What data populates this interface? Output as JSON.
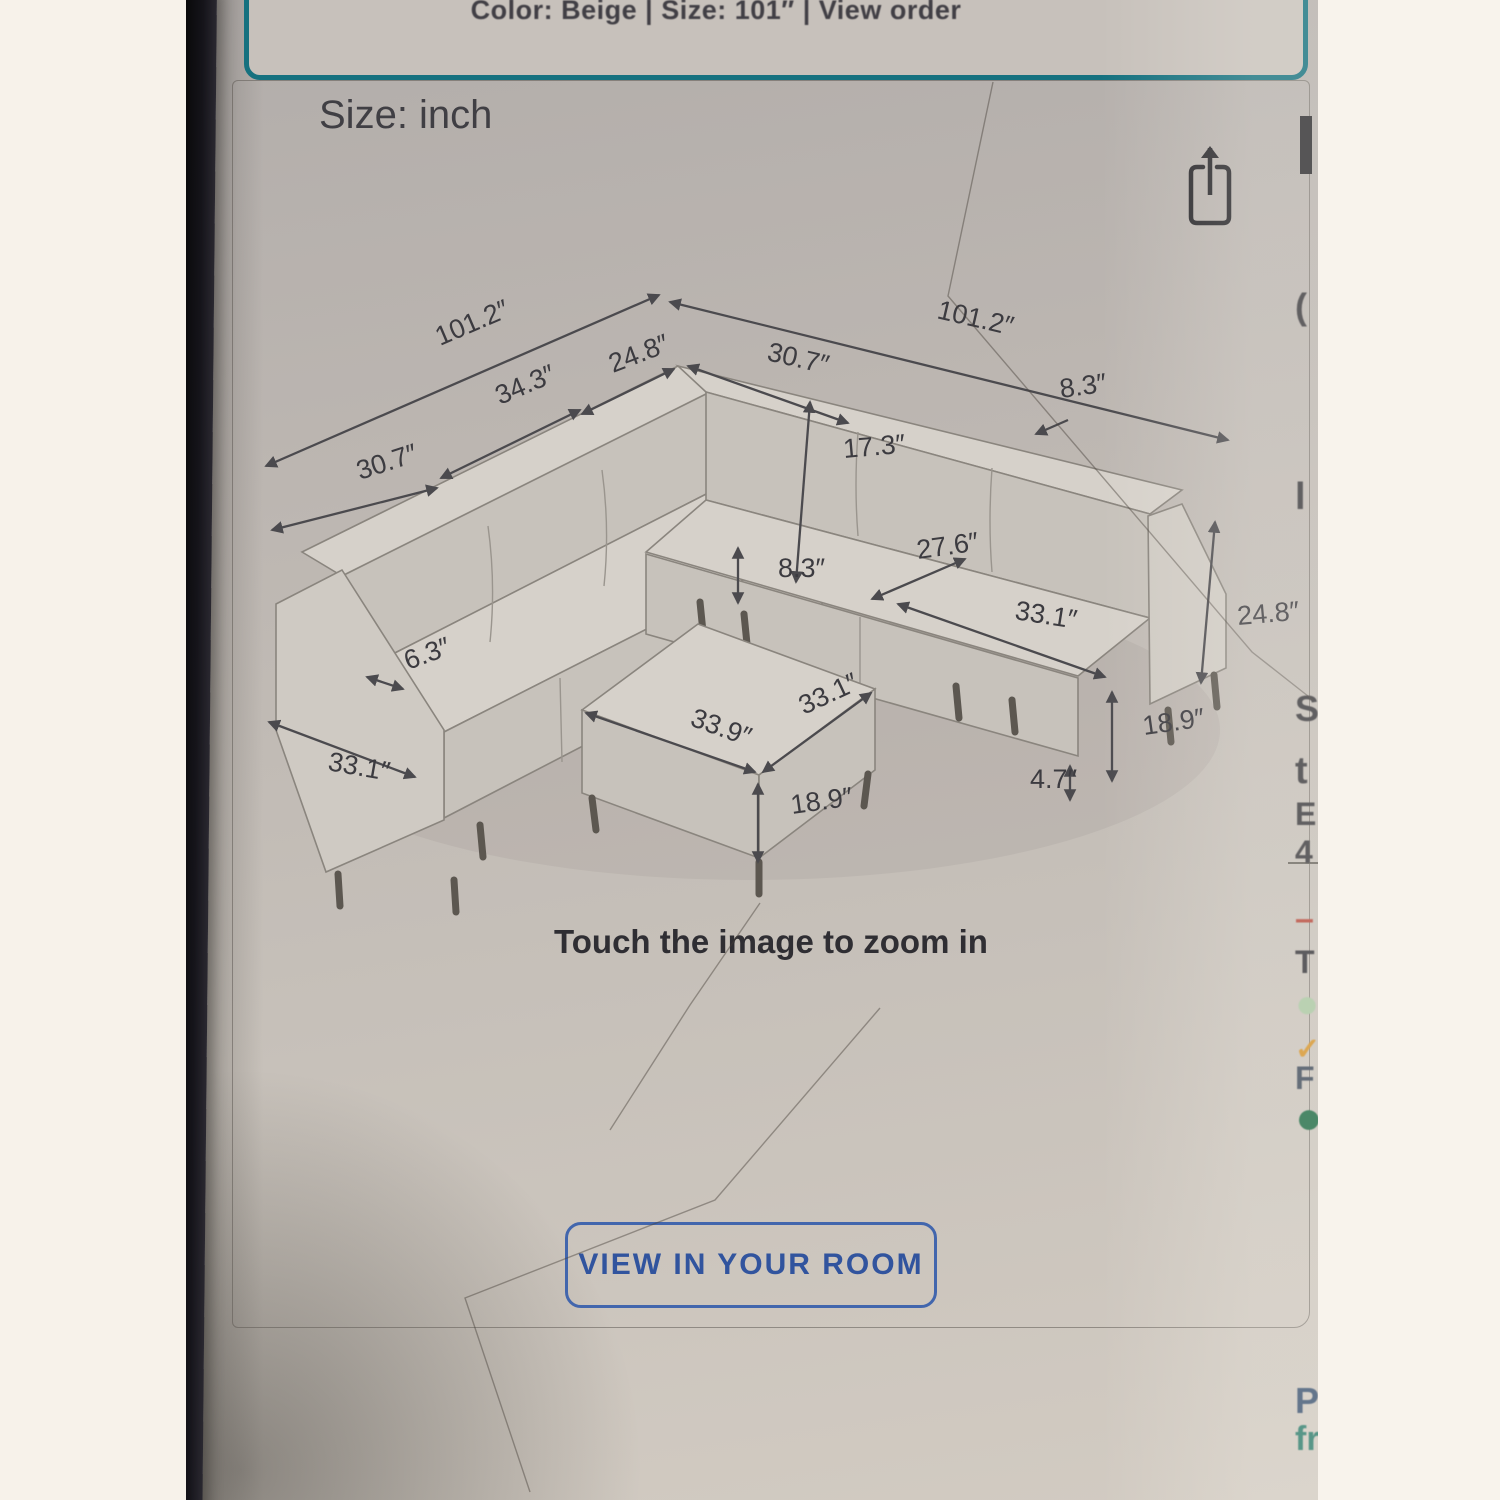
{
  "theme": {
    "teal_accent": "#15717f",
    "button_blue": "#31549e",
    "screen_bg": "#c0bab4",
    "ink": "#3c3b40"
  },
  "order_banner": {
    "text": "Color: Beige | Size: 101″ | View order"
  },
  "gallery": {
    "size_label": "Size: inch",
    "zoom_hint": "Touch the image to zoom in",
    "view_button_label": "VIEW IN YOUR ROOM",
    "selected_thumbnail_index": 3,
    "thumbnails": [
      {
        "name": "sofa-collage-photo"
      },
      {
        "name": "living-room-photo"
      },
      {
        "name": "dimensions-diagram",
        "selected": true,
        "caption": "Size: inch"
      },
      {
        "name": "living-room-fireplace-photo"
      },
      {
        "name": "sofa-front-view"
      },
      {
        "name": "sectional-corner-view"
      },
      {
        "name": "sectional-with-ottoman-view"
      }
    ]
  },
  "diagram": {
    "unit": "inch",
    "labels": [
      {
        "text": "101.2″",
        "x": 210,
        "y": 176,
        "r": -23
      },
      {
        "text": "24.8″",
        "x": 383,
        "y": 203,
        "r": -21
      },
      {
        "text": "30.7″",
        "x": 536,
        "y": 190,
        "r": 13
      },
      {
        "text": "101.2″",
        "x": 706,
        "y": 148,
        "r": 13
      },
      {
        "text": "34.3″",
        "x": 270,
        "y": 235,
        "r": -23
      },
      {
        "text": "30.7″",
        "x": 130,
        "y": 310,
        "r": -18
      },
      {
        "text": "17.3″",
        "x": 614,
        "y": 288,
        "r": -5
      },
      {
        "text": "8.3″",
        "x": 831,
        "y": 228,
        "r": -8
      },
      {
        "text": "8.3″",
        "x": 548,
        "y": 407,
        "r": 0
      },
      {
        "text": "27.6″",
        "x": 688,
        "y": 389,
        "r": -8
      },
      {
        "text": "33.1″",
        "x": 784,
        "y": 449,
        "r": 9
      },
      {
        "text": "24.8″",
        "x": 1008,
        "y": 455,
        "r": -5
      },
      {
        "text": "18.9″",
        "x": 914,
        "y": 565,
        "r": -8
      },
      {
        "text": "4.7″",
        "x": 800,
        "y": 618,
        "r": 0
      },
      {
        "text": "6.3″",
        "x": 178,
        "y": 500,
        "r": -20
      },
      {
        "text": "33.1″",
        "x": 97,
        "y": 600,
        "r": 10
      },
      {
        "text": "33.9″",
        "x": 459,
        "y": 555,
        "r": 20
      },
      {
        "text": "33.1″",
        "x": 574,
        "y": 545,
        "r": -25
      },
      {
        "text": "18.9″",
        "x": 562,
        "y": 644,
        "r": -8
      }
    ]
  },
  "edge_fragments": [
    {
      "ch": "(",
      "y": 286,
      "c": "#3a393d",
      "fs": 36
    },
    {
      "ch": "l",
      "y": 476,
      "c": "#3a393d",
      "fs": 38
    },
    {
      "ch": "S",
      "y": 688,
      "c": "#3a393d",
      "fs": 36
    },
    {
      "ch": "t",
      "y": 750,
      "c": "#3a393d",
      "fs": 38
    },
    {
      "ch": "E",
      "y": 796,
      "c": "#3a393d",
      "fs": 32
    },
    {
      "ch": "4",
      "y": 834,
      "c": "#3a393d",
      "fs": 32
    },
    {
      "ch": "–",
      "y": 900,
      "c": "#b5473a",
      "fs": 34
    },
    {
      "ch": "T",
      "y": 944,
      "c": "#35343a",
      "fs": 32
    },
    {
      "ch": "●",
      "y": 982,
      "c": "#a9c6a2",
      "fs": 40
    },
    {
      "ch": "✓",
      "y": 1032,
      "c": "#d4922a",
      "fs": 30
    },
    {
      "ch": "F",
      "y": 1060,
      "c": "#3f4a5a",
      "fs": 32
    },
    {
      "ch": "●",
      "y": 1090,
      "c": "#1e6b45",
      "fs": 46
    },
    {
      "ch": "P",
      "y": 1380,
      "c": "#3d5472",
      "fs": 36
    },
    {
      "ch": "fr",
      "y": 1420,
      "c": "#2f7d6d",
      "fs": 34
    }
  ]
}
